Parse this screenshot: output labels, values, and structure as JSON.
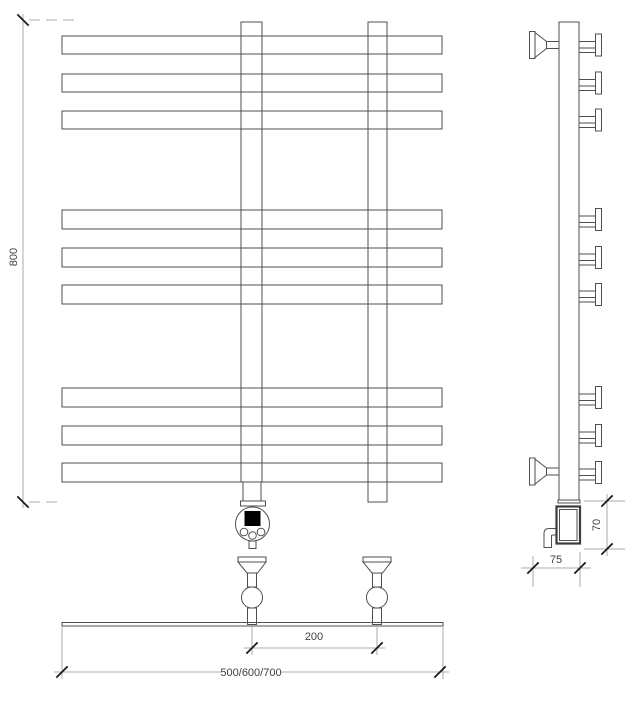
{
  "drawing": {
    "title": "heated-towel-rail-technical-drawing",
    "dims": {
      "height": "800",
      "valve_spacing": "200",
      "width_options": "500/600/700",
      "heater_height": "70",
      "wall_depth": "75"
    },
    "colors": {
      "line": "#4f4f4f",
      "dim_line": "#ababab",
      "tick": "#1c1c1c",
      "text": "#3f3f3f",
      "display": "#000000",
      "background": "#ffffff"
    }
  }
}
